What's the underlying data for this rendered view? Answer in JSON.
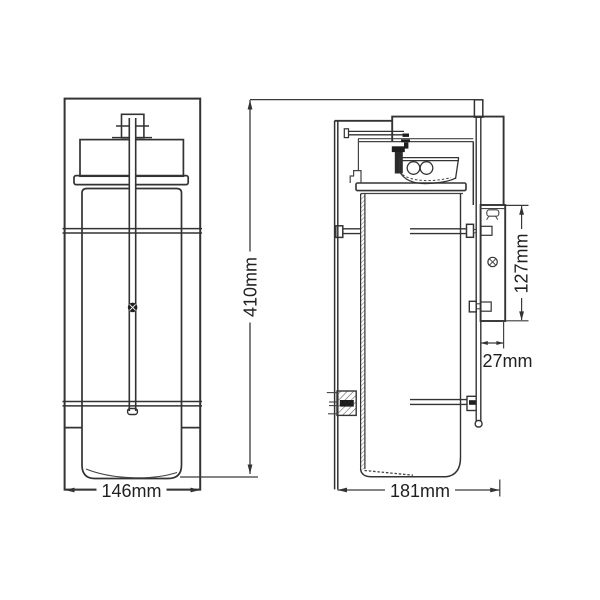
{
  "dimensions": {
    "overall_height": "410mm",
    "front_width": "146mm",
    "side_projection": "181mm",
    "wall_plate_height": "127mm",
    "wall_clearance": "27mm"
  },
  "colors": {
    "line": "#333333",
    "background": "#ffffff",
    "text": "#1f1f1f",
    "hatch": "#555555"
  }
}
